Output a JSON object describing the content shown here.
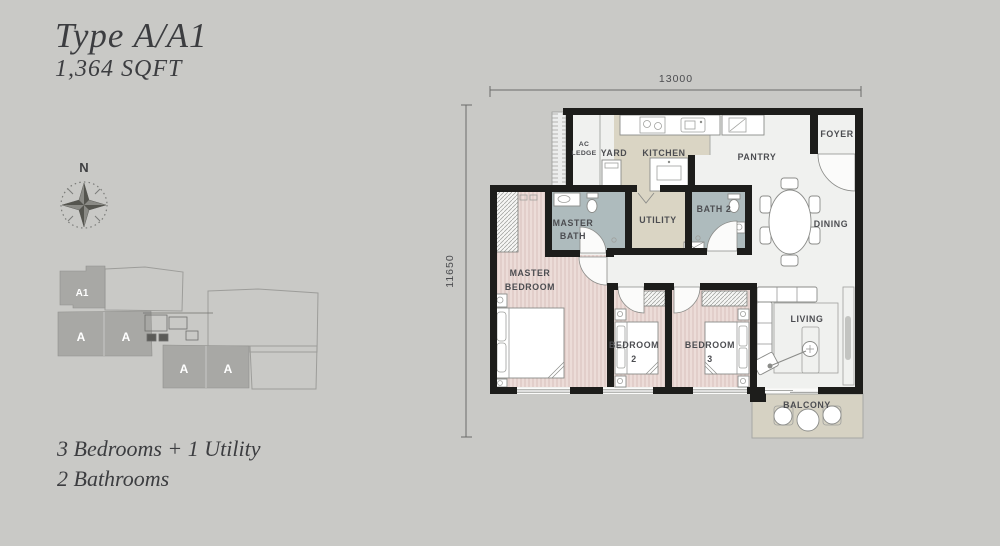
{
  "header": {
    "title": "Type A/A1",
    "area": "1,364 SQFT"
  },
  "summary": {
    "line1": "3 Bedrooms + 1 Utility",
    "line2": "2 Bathrooms"
  },
  "compass": {
    "label": "N"
  },
  "key_plan": {
    "units": [
      "A1",
      "A",
      "A",
      "A",
      "A"
    ]
  },
  "dimensions": {
    "width": "13000",
    "height": "11650"
  },
  "rooms": {
    "ac_ledge": {
      "l1": "AC",
      "l2": "LEDGE"
    },
    "yard": {
      "label": "YARD"
    },
    "kitchen": {
      "label": "KITCHEN"
    },
    "pantry": {
      "label": "PANTRY"
    },
    "foyer": {
      "label": "FOYER"
    },
    "utility": {
      "label": "UTILITY"
    },
    "master_bath": {
      "l1": "MASTER",
      "l2": "BATH"
    },
    "bath2": {
      "label": "BATH 2"
    },
    "dining": {
      "label": "DINING"
    },
    "master_bedroom": {
      "l1": "MASTER",
      "l2": "BEDROOM"
    },
    "bedroom2": {
      "l1": "BEDROOM",
      "l2": "2"
    },
    "bedroom3": {
      "l1": "BEDROOM",
      "l2": "3"
    },
    "living": {
      "label": "LIVING"
    },
    "balcony": {
      "label": "BALCONY"
    }
  },
  "colors": {
    "background": "#c9c9c6",
    "wall": "#1d1d1b",
    "unit_floor": "#f0f1ef",
    "bedroom_floor": "#ecdcd8",
    "bedroom_stripe": "#dfc8c4",
    "bath_floor": "#aebbbd",
    "kitchen_floor": "#dad5c4",
    "balcony_floor": "#d6d2c3",
    "keyplan_unit": "#a8a8a5",
    "text_dark": "#3c3d40",
    "plan_text": "#4c4d51"
  }
}
